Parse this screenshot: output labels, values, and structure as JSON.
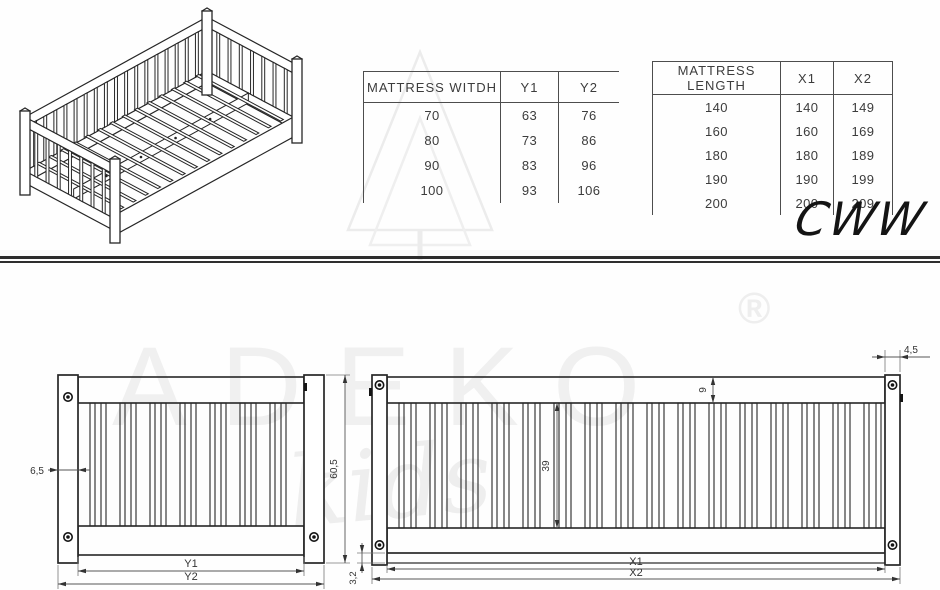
{
  "title_code": "CWW",
  "watermark": {
    "brand": "ADEKO",
    "registered": "®",
    "script": "kids"
  },
  "tables": {
    "width": {
      "header": [
        "MATTRESS WITDH",
        "Y1",
        "Y2"
      ],
      "rows": [
        [
          "70",
          "63",
          "76"
        ],
        [
          "80",
          "73",
          "86"
        ],
        [
          "90",
          "83",
          "96"
        ],
        [
          "100",
          "93",
          "106"
        ]
      ]
    },
    "length": {
      "header": [
        "MATTRESS LENGTH",
        "X1",
        "X2"
      ],
      "rows": [
        [
          "140",
          "140",
          "149"
        ],
        [
          "160",
          "160",
          "169"
        ],
        [
          "180",
          "180",
          "189"
        ],
        [
          "190",
          "190",
          "199"
        ],
        [
          "200",
          "200",
          "209"
        ]
      ]
    }
  },
  "views": {
    "front": {
      "dims": {
        "post_width": "6,5",
        "overall_height": "60,5",
        "inner_width": "Y1",
        "overall_width": "Y2"
      }
    },
    "side": {
      "dims": {
        "post_depth": "4,5",
        "top_rail_height": "9",
        "slat_height": "39",
        "base_lip": "3,2",
        "inner_length": "X1",
        "overall_length": "X2"
      }
    }
  }
}
